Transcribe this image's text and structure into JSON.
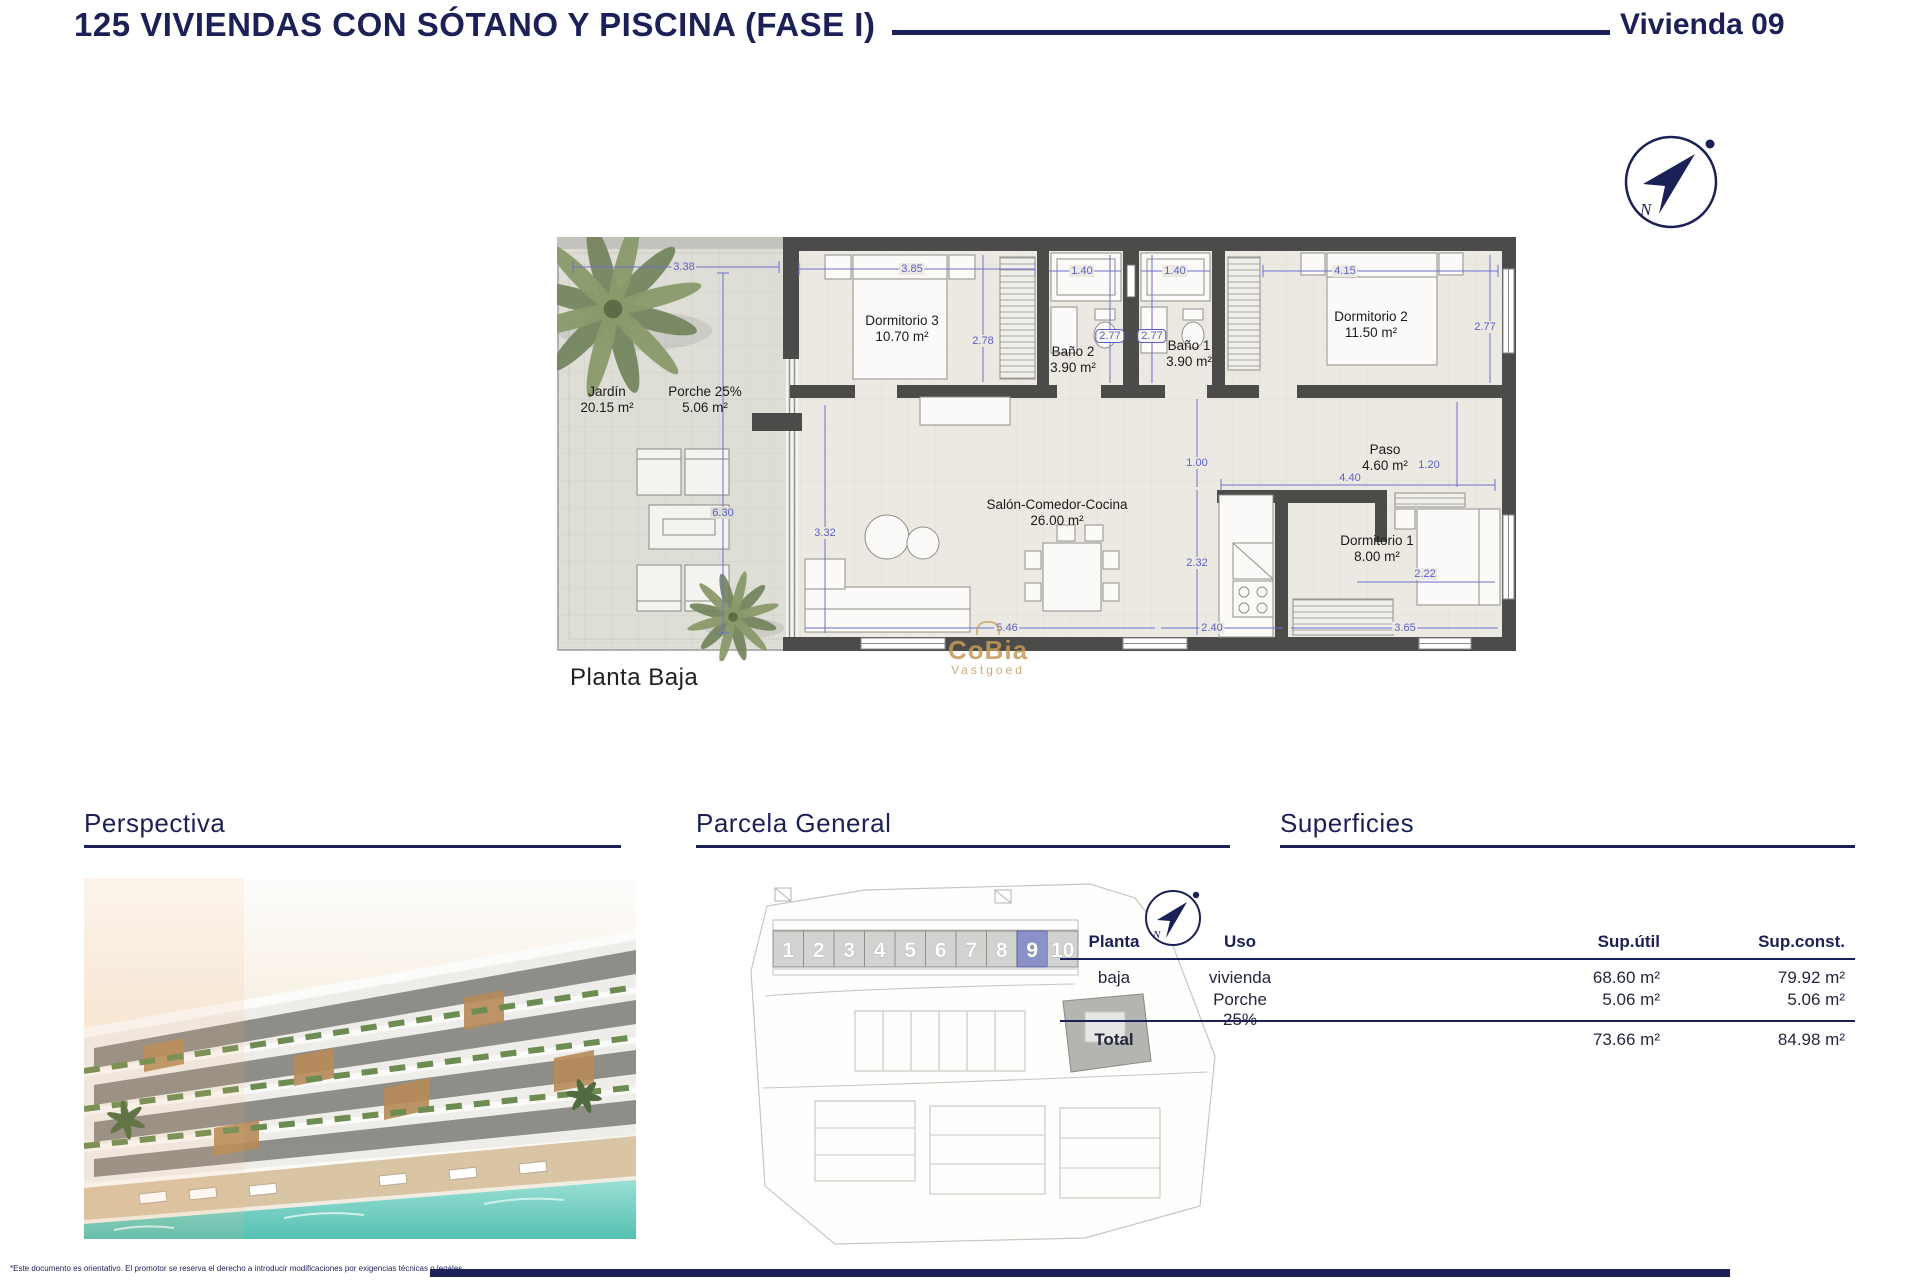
{
  "header": {
    "title": "125 VIVIENDAS CON SÓTANO Y PISCINA (FASE I)",
    "unit_label": "Vivienda 09"
  },
  "compass": {
    "north_label": "N"
  },
  "floor_plan": {
    "name": "Planta Baja",
    "watermark": {
      "line1": "CoBia",
      "line2": "Vastgoed"
    },
    "rooms": {
      "jardin": {
        "name": "Jardín",
        "area": "20.15 m²"
      },
      "porche": {
        "name": "Porche 25%",
        "area": "5.06 m²"
      },
      "dorm3": {
        "name": "Dormitorio 3",
        "area": "10.70 m²"
      },
      "bano2": {
        "name": "Baño 2",
        "area": "3.90 m²"
      },
      "bano1": {
        "name": "Baño 1",
        "area": "3.90 m²"
      },
      "dorm2": {
        "name": "Dormitorio 2",
        "area": "11.50 m²"
      },
      "paso": {
        "name": "Paso",
        "area": "4.60 m²"
      },
      "salon": {
        "name": "Salón-Comedor-Cocina",
        "area": "26.00 m²"
      },
      "dorm1": {
        "name": "Dormitorio 1",
        "area": "8.00 m²"
      }
    },
    "dims": {
      "jardin_width": "3.38",
      "dorm3_width": "3.85",
      "bano2_width": "1.40",
      "bano1_width": "1.40",
      "dorm2_width": "4.15",
      "dorm3_depth": "2.78",
      "bano2_depth": "2.77",
      "bano1_depth": "2.77",
      "dorm2_depth": "2.77",
      "jardin_depth": "6.30",
      "salon_depth": "3.32",
      "paso_opening": "1.00",
      "paso_width": "4.40",
      "paso_depth": "1.20",
      "cocina_depth": "2.32",
      "dorm1_inner": "2.22",
      "salon_width": "5.46",
      "cocina_width": "2.40",
      "dorm1_width": "3.65"
    }
  },
  "sections": {
    "perspectiva": {
      "title": "Perspectiva"
    },
    "parcela": {
      "title": "Parcela General",
      "units": [
        "1",
        "2",
        "3",
        "4",
        "5",
        "6",
        "7",
        "8",
        "9",
        "10"
      ],
      "highlighted_unit": "9"
    },
    "superficies": {
      "title": "Superficies",
      "columns": [
        "Planta",
        "Uso",
        "Sup.útil",
        "Sup.const."
      ],
      "rows": [
        {
          "planta": "baja",
          "uso": "vivienda",
          "sup_util": "68.60 m²",
          "sup_const": "79.92 m²"
        },
        {
          "planta": "",
          "uso": "Porche 25%",
          "sup_util": "5.06 m²",
          "sup_const": "5.06 m²"
        }
      ],
      "total": {
        "label": "Total",
        "sup_util": "73.66 m²",
        "sup_const": "84.98 m²"
      }
    }
  },
  "footer": {
    "disclaimer": "*Este documento es orientativo. El promotor se reserva el derecho a introducir modificaciones por exigencias técnicas o legales"
  }
}
